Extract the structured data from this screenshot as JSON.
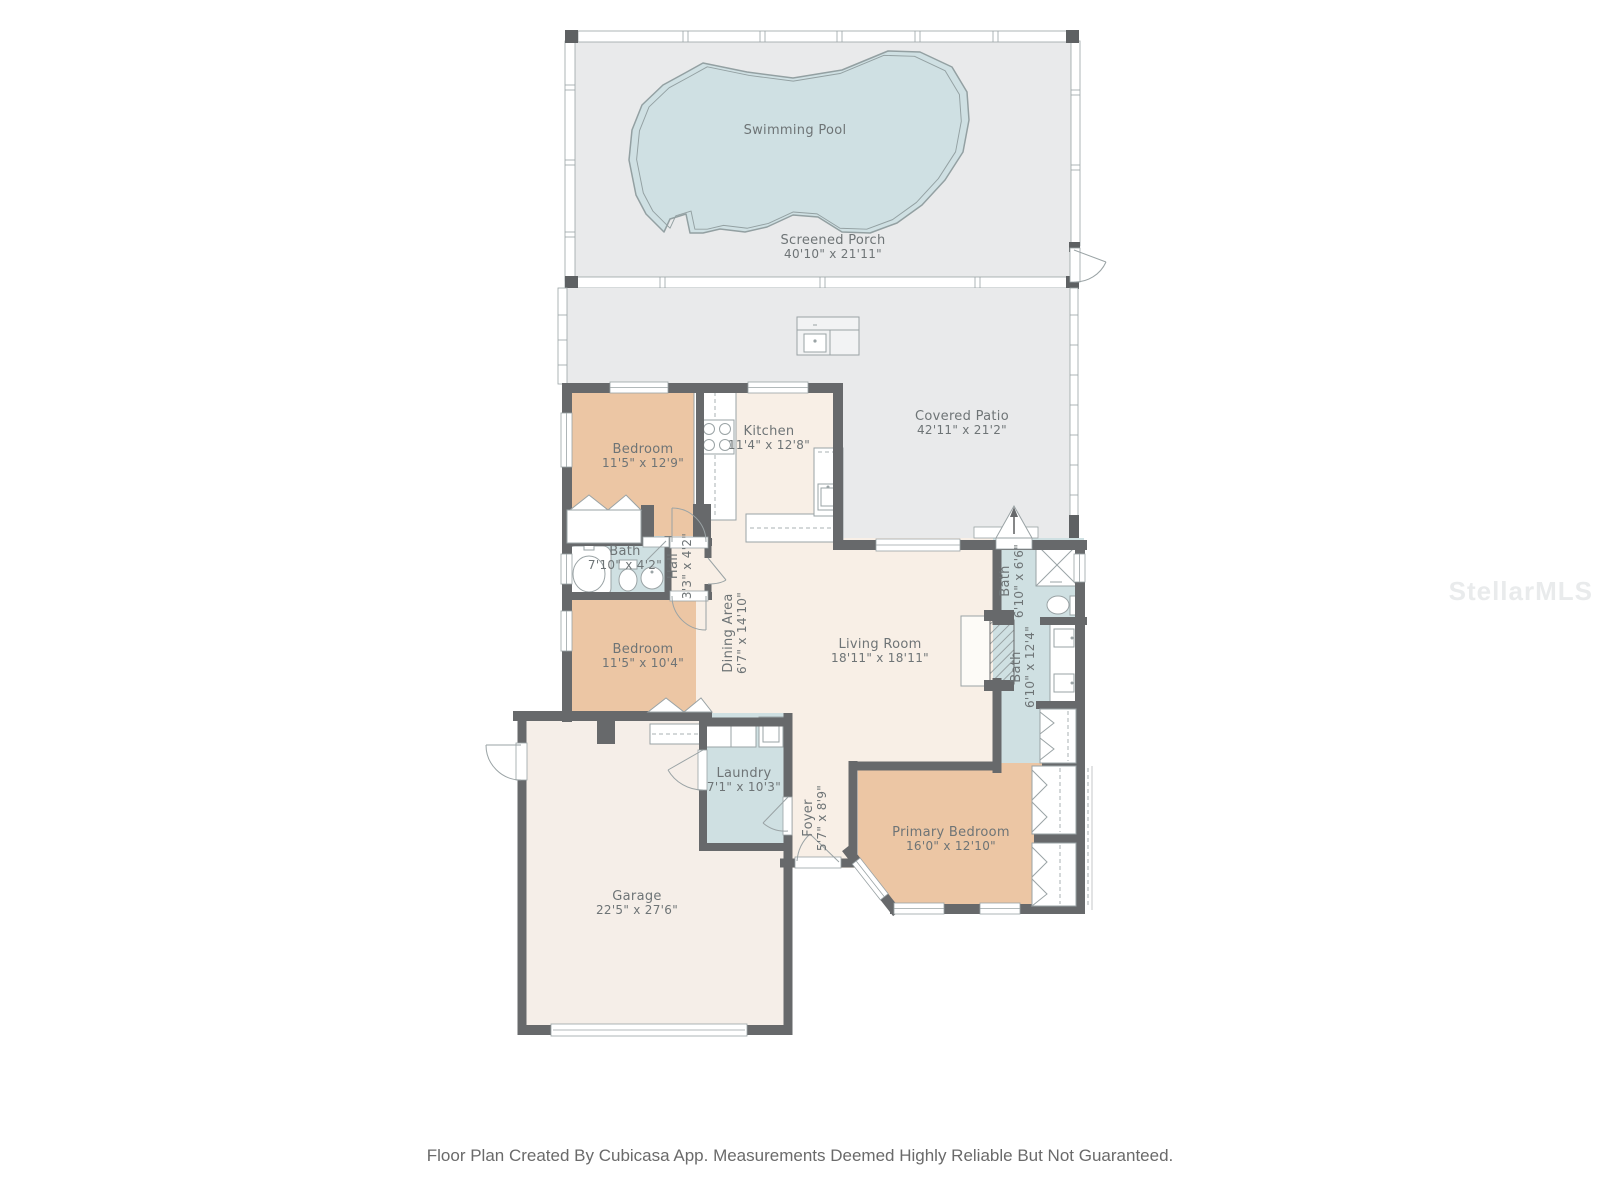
{
  "footer": "Floor Plan Created By Cubicasa App. Measurements Deemed Highly Reliable But Not Guaranteed.",
  "watermark": "StellarMLS",
  "colors": {
    "wall": "#67696b",
    "bedroom_fill": "#ecc6a4",
    "living_fill": "#f8efe6",
    "garage_fill": "#f5eee8",
    "wet_room_fill": "#cfe0e2",
    "patio_fill": "#e9eaeb",
    "pool_fill": "#cfe0e3",
    "label_text": "#6e7476"
  },
  "rooms": {
    "swimming_pool": {
      "name": "Swimming Pool",
      "dims": ""
    },
    "screened_porch": {
      "name": "Screened Porch",
      "dims": "40'10\" x 21'11\""
    },
    "covered_patio": {
      "name": "Covered Patio",
      "dims": "42'11\" x 21'2\""
    },
    "kitchen": {
      "name": "Kitchen",
      "dims": "11'4\" x 12'8\""
    },
    "bedroom1": {
      "name": "Bedroom",
      "dims": "11'5\" x 12'9\""
    },
    "bath1": {
      "name": "Bath",
      "dims": "7'10\" x 4'2\""
    },
    "hall": {
      "name": "Hall",
      "dims": "3'3\" x 4'2\""
    },
    "bedroom2": {
      "name": "Bedroom",
      "dims": "11'5\" x 10'4\""
    },
    "dining": {
      "name": "Dining Area",
      "dims": "6'7\" x 14'10\""
    },
    "living": {
      "name": "Living Room",
      "dims": "18'11\" x 18'11\""
    },
    "bath2": {
      "name": "Bath",
      "dims": "6'10\" x 6'6\""
    },
    "bath3": {
      "name": "Bath",
      "dims": "6'10\" x 12'4\""
    },
    "laundry": {
      "name": "Laundry",
      "dims": "7'1\" x 10'3\""
    },
    "foyer": {
      "name": "Foyer",
      "dims": "5'7\" x 8'9\""
    },
    "primary_bedroom": {
      "name": "Primary Bedroom",
      "dims": "16'0\" x 12'10\""
    },
    "garage": {
      "name": "Garage",
      "dims": "22'5\" x 27'6\""
    }
  }
}
